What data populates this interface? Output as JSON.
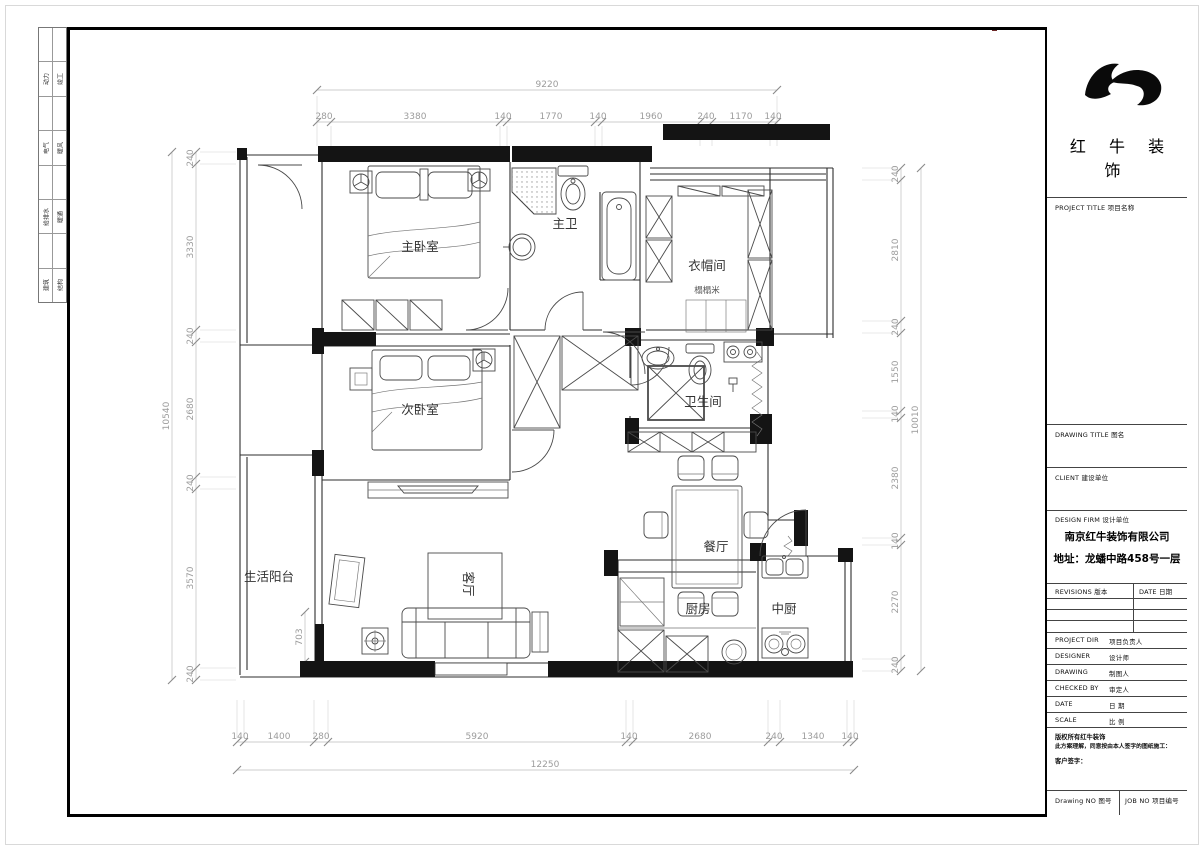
{
  "sign": {
    "rows": [
      [
        "动力",
        "竣工"
      ],
      [
        "电气",
        "暖风"
      ],
      [
        "给排水",
        "暖通"
      ],
      [
        "建筑",
        "结构"
      ]
    ]
  },
  "title": {
    "company_name": "红 牛 装 饰",
    "project_title": "PROJECT TITLE   项目名称",
    "drawing_title": "DRAWING TITLE   图名",
    "client": "CLIENT  建设单位",
    "design_firm": "DESIGN FIRM   设计单位",
    "firm_name": "南京红牛装饰有限公司",
    "firm_address": "地址：龙蟠中路458号一层",
    "revisions": "REVISIONS 版本",
    "rev_date": "DATE 日期",
    "rows": [
      {
        "en": "PROJECT DIR",
        "zh": "项目负责人"
      },
      {
        "en": "DESIGNER",
        "zh": "设计师"
      },
      {
        "en": "DRAWING",
        "zh": "制图人"
      },
      {
        "en": "CHECKED BY",
        "zh": "审定人"
      },
      {
        "en": "DATE",
        "zh": "日  期"
      },
      {
        "en": "SCALE",
        "zh": "比  例"
      }
    ],
    "copyright_line1": "版权所有红牛装饰",
    "copyright_line2": "此方案理解，同意按由本人签字的图纸施工：",
    "client_sign": "客户签字：",
    "drawing_no": "Drawing NO  图号",
    "job_no": "JOB NO  项目编号"
  },
  "plan": {
    "rooms": {
      "master_bedroom": "主卧室",
      "master_bath": "主卫",
      "cloakroom": "衣帽间",
      "tatami": "榻榻米",
      "second_bedroom": "次卧室",
      "bathroom": "卫生间",
      "dining": "餐厅",
      "balcony": "生活阳台",
      "living": "客厅",
      "kitchen": "厨房",
      "chinese_kitchen": "中厨"
    },
    "dims": {
      "top_total": "9220",
      "top": [
        "280",
        "3380",
        "140",
        "1770",
        "140",
        "1960",
        "240",
        "1170",
        "140"
      ],
      "left_total": "10540",
      "left": [
        "240",
        "3330",
        "240",
        "2680",
        "240",
        "3570",
        "240"
      ],
      "right_total": "10010",
      "right": [
        "240",
        "2810",
        "240",
        "1550",
        "140",
        "2380",
        "140",
        "2270",
        "240"
      ],
      "bottom_total": "12250",
      "bottom": [
        "140",
        "1400",
        "280",
        "5920",
        "140",
        "2680",
        "240",
        "1340",
        "140"
      ],
      "extra": "703"
    }
  }
}
